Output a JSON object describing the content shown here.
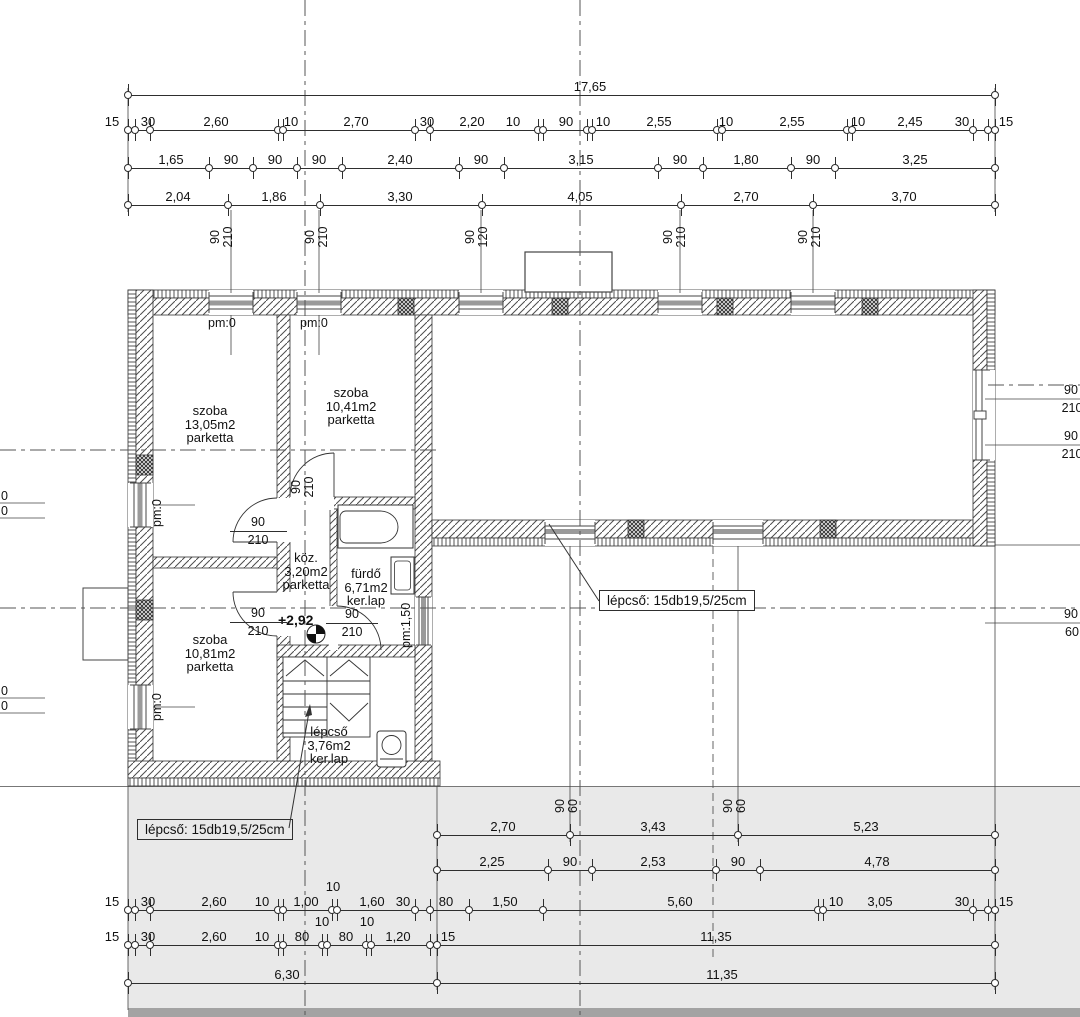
{
  "colors": {
    "paper": "#ffffff",
    "terrace_fill": "#e9e9e9",
    "terrace_band": "#a3a3a3",
    "line": "#2e2e2e",
    "sill_gray": "#9a9a9a"
  },
  "rooms": [
    {
      "name": "szoba",
      "area": "13,05m2",
      "floor": "parketta"
    },
    {
      "name": "szoba",
      "area": "10,41m2",
      "floor": "parketta"
    },
    {
      "name": "köz.",
      "area": "3,20m2",
      "floor": "parketta"
    },
    {
      "name": "fürdő",
      "area": "6,71m2",
      "floor": "ker.lap"
    },
    {
      "name": "szoba",
      "area": "10,81m2",
      "floor": "parketta"
    },
    {
      "name": "lépcső",
      "area": "3,76m2",
      "floor": "ker.lap"
    }
  ],
  "notes": {
    "stair_note_left": "lépcső: 15db19,5/25cm",
    "stair_note_right": "lépcső: 15db19,5/25cm"
  },
  "levels": {
    "hall_level": "+2,92",
    "pm_room1": "pm:0",
    "pm_room2": "pm:0",
    "pm_wall_upper": "pm:0",
    "pm_wall_lower": "pm:0",
    "pm_bath": "pm:1,50"
  },
  "dim_rows": [
    {
      "y": 95,
      "pts": [
        128,
        995
      ],
      "labels": [
        {
          "t": "17,65",
          "x": 590
        }
      ]
    },
    {
      "y": 130,
      "pts": [
        128,
        135,
        150,
        278,
        283,
        415,
        430,
        538,
        543,
        587,
        592,
        717,
        722,
        847,
        852,
        973,
        988,
        995
      ],
      "labels": [
        {
          "t": "15",
          "x": 112
        },
        {
          "t": "30",
          "x": 148
        },
        {
          "t": "2,60",
          "x": 216
        },
        {
          "t": "10",
          "x": 291
        },
        {
          "t": "2,70",
          "x": 356
        },
        {
          "t": "30",
          "x": 427
        },
        {
          "t": "2,20",
          "x": 472
        },
        {
          "t": "10",
          "x": 513
        },
        {
          "t": "90",
          "x": 566
        },
        {
          "t": "10",
          "x": 603
        },
        {
          "t": "2,55",
          "x": 659
        },
        {
          "t": "10",
          "x": 726
        },
        {
          "t": "2,55",
          "x": 792
        },
        {
          "t": "10",
          "x": 858
        },
        {
          "t": "2,45",
          "x": 910
        },
        {
          "t": "30",
          "x": 962
        },
        {
          "t": "15",
          "x": 1006
        }
      ]
    },
    {
      "y": 168,
      "pts": [
        128,
        209,
        253,
        297,
        342,
        459,
        504,
        658,
        703,
        791,
        835,
        995
      ],
      "labels": [
        {
          "t": "1,65",
          "x": 171
        },
        {
          "t": "90",
          "x": 231
        },
        {
          "t": "90",
          "x": 275
        },
        {
          "t": "90",
          "x": 319
        },
        {
          "t": "2,40",
          "x": 400
        },
        {
          "t": "90",
          "x": 481
        },
        {
          "t": "3,15",
          "x": 581
        },
        {
          "t": "90",
          "x": 680
        },
        {
          "t": "1,80",
          "x": 746
        },
        {
          "t": "90",
          "x": 813
        },
        {
          "t": "3,25",
          "x": 915
        }
      ]
    },
    {
      "y": 205,
      "pts": [
        128,
        228,
        320,
        482,
        681,
        813,
        995
      ],
      "labels": [
        {
          "t": "2,04",
          "x": 178
        },
        {
          "t": "1,86",
          "x": 274
        },
        {
          "t": "3,30",
          "x": 400
        },
        {
          "t": "4,05",
          "x": 580
        },
        {
          "t": "2,70",
          "x": 746
        },
        {
          "t": "3,70",
          "x": 904
        }
      ]
    },
    {
      "y": 835,
      "pts": [
        437,
        570,
        738,
        995
      ],
      "labels": [
        {
          "t": "2,70",
          "x": 503
        },
        {
          "t": "3,43",
          "x": 653
        },
        {
          "t": "5,23",
          "x": 866
        }
      ]
    },
    {
      "y": 870,
      "pts": [
        437,
        548,
        592,
        716,
        760,
        995
      ],
      "labels": [
        {
          "t": "2,25",
          "x": 492
        },
        {
          "t": "90",
          "x": 570
        },
        {
          "t": "2,53",
          "x": 653
        },
        {
          "t": "90",
          "x": 738
        },
        {
          "t": "4,78",
          "x": 877
        }
      ]
    },
    {
      "y": 910,
      "pts": [
        128,
        135,
        150,
        278,
        283,
        332,
        337,
        415,
        430,
        469,
        543,
        818,
        823,
        973,
        988,
        995
      ],
      "labels": [
        {
          "t": "15",
          "x": 112
        },
        {
          "t": "30",
          "x": 148
        },
        {
          "t": "2,60",
          "x": 214
        },
        {
          "t": "10",
          "x": 262
        },
        {
          "t": "1,00",
          "x": 306
        },
        {
          "t": "10",
          "x": 333,
          "dy": -15
        },
        {
          "t": "1,60",
          "x": 372
        },
        {
          "t": "30",
          "x": 403
        },
        {
          "t": "80",
          "x": 446
        },
        {
          "t": "1,50",
          "x": 505
        },
        {
          "t": "5,60",
          "x": 680
        },
        {
          "t": "10",
          "x": 836
        },
        {
          "t": "3,05",
          "x": 880
        },
        {
          "t": "30",
          "x": 962
        },
        {
          "t": "15",
          "x": 1006
        }
      ]
    },
    {
      "y": 945,
      "pts": [
        128,
        135,
        150,
        278,
        283,
        322,
        327,
        366,
        371,
        430,
        437,
        995
      ],
      "labels": [
        {
          "t": "15",
          "x": 112
        },
        {
          "t": "30",
          "x": 148
        },
        {
          "t": "2,60",
          "x": 214
        },
        {
          "t": "10",
          "x": 262
        },
        {
          "t": "80",
          "x": 302
        },
        {
          "t": "10",
          "x": 322,
          "dy": -15
        },
        {
          "t": "80",
          "x": 346
        },
        {
          "t": "10",
          "x": 367,
          "dy": -15
        },
        {
          "t": "1,20",
          "x": 398
        },
        {
          "t": "15",
          "x": 448
        },
        {
          "t": "11,35",
          "x": 716
        }
      ]
    },
    {
      "y": 983,
      "pts": [
        128,
        437,
        995
      ],
      "labels": [
        {
          "t": "6,30",
          "x": 287
        },
        {
          "t": "11,35",
          "x": 722
        }
      ]
    }
  ],
  "v_pairs": [
    {
      "x": 215,
      "y": 237,
      "a": "90",
      "b": "210"
    },
    {
      "x": 310,
      "y": 237,
      "a": "90",
      "b": "210"
    },
    {
      "x": 470,
      "y": 237,
      "a": "90",
      "b": "120"
    },
    {
      "x": 668,
      "y": 237,
      "a": "90",
      "b": "210"
    },
    {
      "x": 803,
      "y": 237,
      "a": "90",
      "b": "210"
    },
    {
      "x": 296,
      "y": 487,
      "a": "90",
      "b": "210"
    },
    {
      "x": 560,
      "y": 806,
      "a": "90",
      "b": "60"
    },
    {
      "x": 728,
      "y": 806,
      "a": "90",
      "b": "60"
    }
  ],
  "frac_tags": [
    {
      "cx": 258,
      "ry": 531,
      "w": 57,
      "a": "90",
      "b": "210"
    },
    {
      "cx": 258,
      "ry": 622,
      "w": 57,
      "a": "90",
      "b": "210"
    },
    {
      "cx": 352,
      "ry": 623,
      "w": 52,
      "a": "90",
      "b": "210"
    }
  ],
  "edge_tags_right": [
    {
      "ry": 399,
      "a": "90",
      "b": "210"
    },
    {
      "ry": 445,
      "a": "90",
      "b": "210"
    },
    {
      "ry": 623,
      "a": "90",
      "b": "60"
    }
  ],
  "edge_tags_left": [
    {
      "y": 489,
      "t": "0"
    },
    {
      "y": 504,
      "t": "0"
    },
    {
      "y": 684,
      "t": "0"
    },
    {
      "y": 699,
      "t": "0"
    }
  ]
}
